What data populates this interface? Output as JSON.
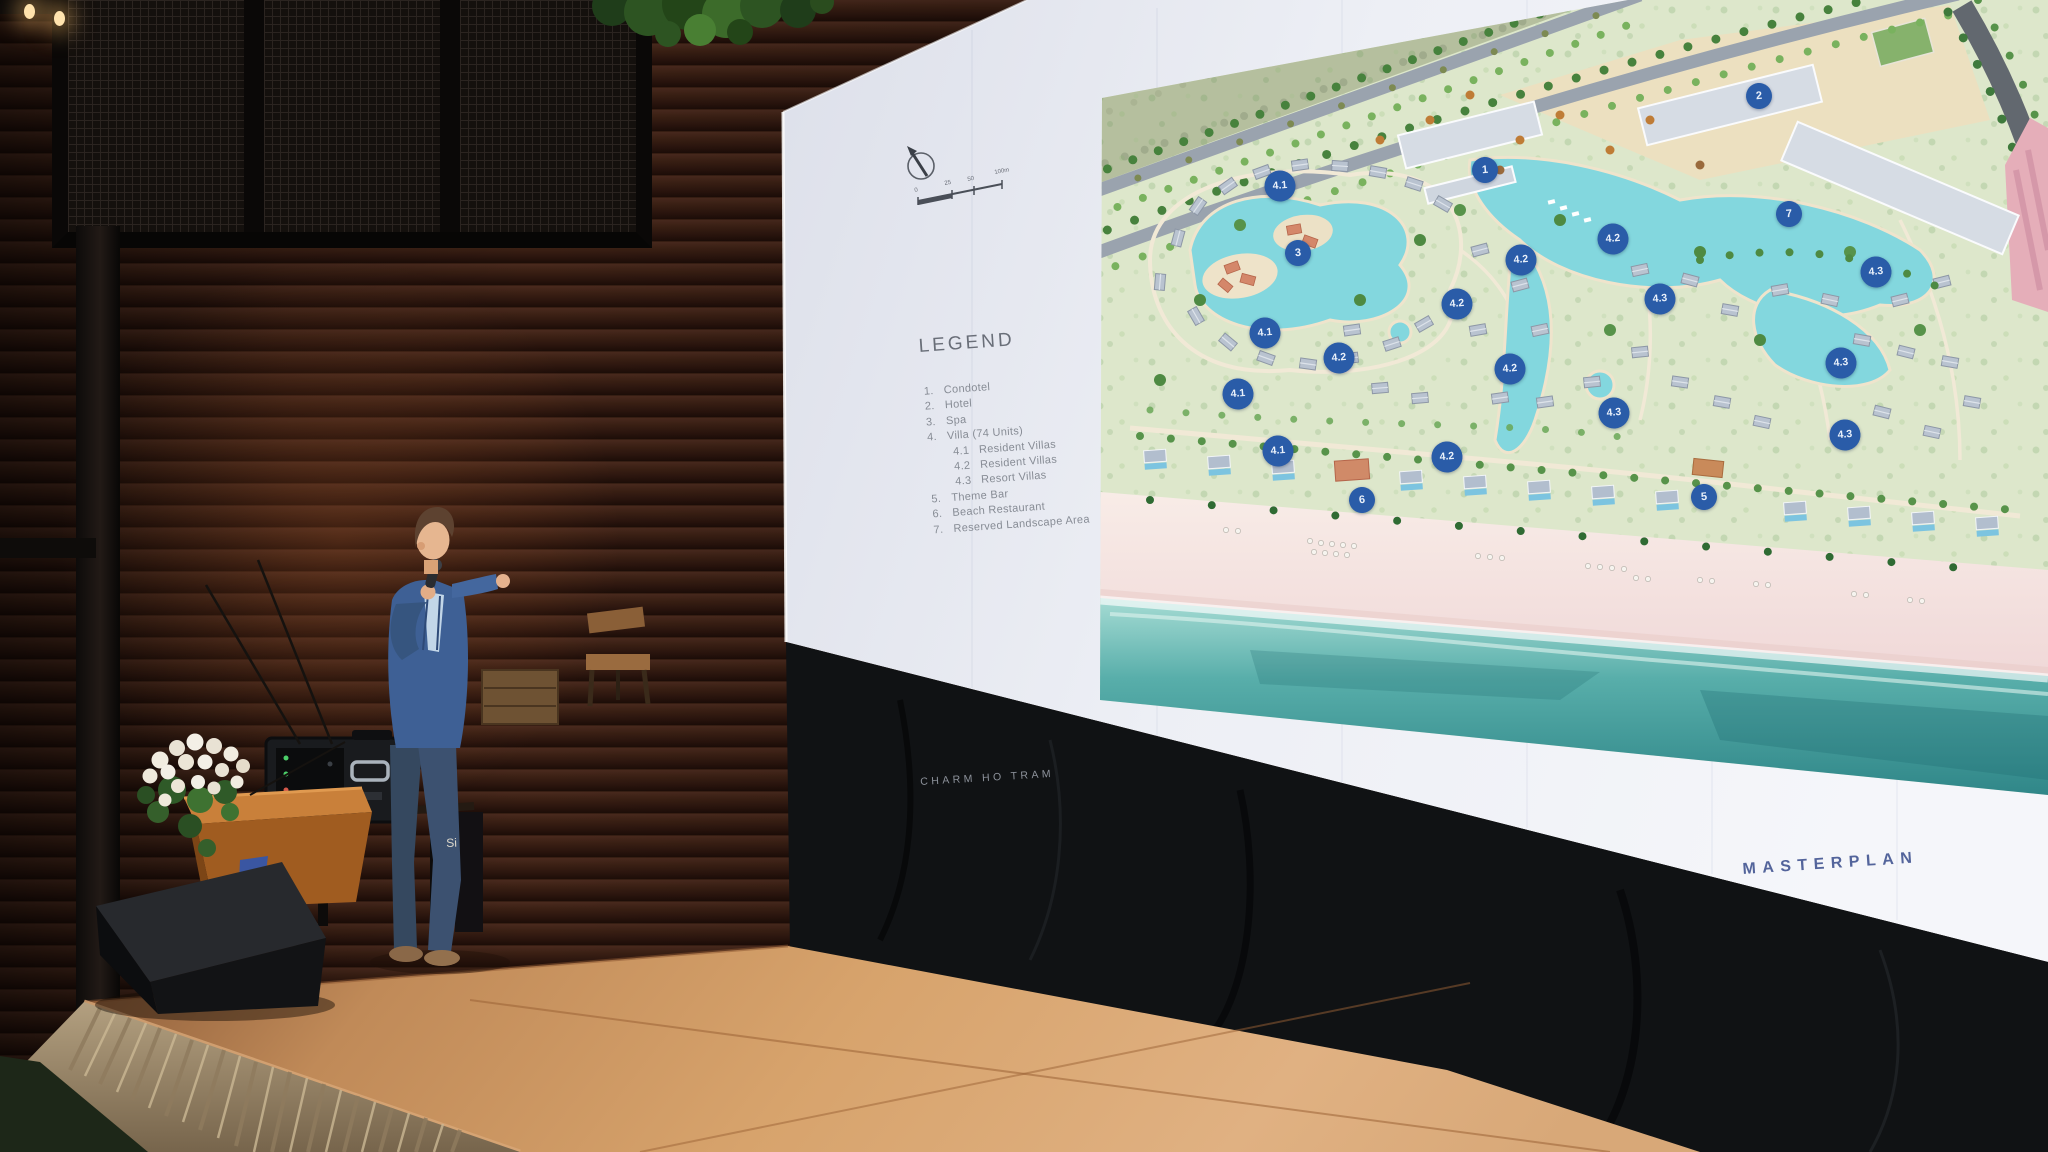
{
  "slide": {
    "legend_title": "LEGEND",
    "legend": {
      "items": [
        {
          "num": "1.",
          "label": "Condotel"
        },
        {
          "num": "2.",
          "label": "Hotel"
        },
        {
          "num": "3.",
          "label": "Spa"
        },
        {
          "num": "4.",
          "label": "Villa (74 Units)"
        },
        {
          "num": "4.1",
          "label": "Resident Villas"
        },
        {
          "num": "4.2",
          "label": "Resident Villas"
        },
        {
          "num": "4.3",
          "label": "Resort Villas"
        },
        {
          "num": "5.",
          "label": "Theme Bar"
        },
        {
          "num": "6.",
          "label": "Beach Restaurant"
        },
        {
          "num": "7.",
          "label": "Reserved Landscape Area"
        }
      ]
    },
    "footer_left": "CHARM HO TRAM",
    "footer_right": "MASTERPLAN",
    "scale": {
      "labels": [
        "0",
        "25",
        "50",
        "100m"
      ]
    }
  },
  "map": {
    "markers": [
      {
        "label": "1",
        "x": 1485,
        "y": 170
      },
      {
        "label": "2",
        "x": 1759,
        "y": 96
      },
      {
        "label": "3",
        "x": 1298,
        "y": 253
      },
      {
        "label": "7",
        "x": 1789,
        "y": 214
      },
      {
        "label": "4.1",
        "x": 1280,
        "y": 186
      },
      {
        "label": "4.1",
        "x": 1265,
        "y": 333
      },
      {
        "label": "4.1",
        "x": 1238,
        "y": 394
      },
      {
        "label": "4.1",
        "x": 1278,
        "y": 451
      },
      {
        "label": "4.2",
        "x": 1613,
        "y": 239
      },
      {
        "label": "4.2",
        "x": 1521,
        "y": 260
      },
      {
        "label": "4.2",
        "x": 1457,
        "y": 304
      },
      {
        "label": "4.2",
        "x": 1339,
        "y": 358
      },
      {
        "label": "4.2",
        "x": 1510,
        "y": 369
      },
      {
        "label": "4.2",
        "x": 1447,
        "y": 457
      },
      {
        "label": "4.3",
        "x": 1876,
        "y": 272
      },
      {
        "label": "4.3",
        "x": 1660,
        "y": 299
      },
      {
        "label": "4.3",
        "x": 1841,
        "y": 363
      },
      {
        "label": "4.3",
        "x": 1614,
        "y": 413
      },
      {
        "label": "4.3",
        "x": 1845,
        "y": 435
      },
      {
        "label": "5",
        "x": 1704,
        "y": 497
      },
      {
        "label": "6",
        "x": 1362,
        "y": 500
      }
    ]
  },
  "stage": {
    "partial_signage": "Si"
  },
  "colors": {
    "marker_blue": "#2a5ca8",
    "masterplan_text": "#53649b",
    "legend_text": "#878c95",
    "screen_white": "#eef0f6",
    "lagoon": "#7fd2dc",
    "ocean_teal": "#3f9e9b",
    "beach_pink": "#f3e0df",
    "stage_floor": "#c9905e",
    "suit_blue": "#3e6095"
  }
}
